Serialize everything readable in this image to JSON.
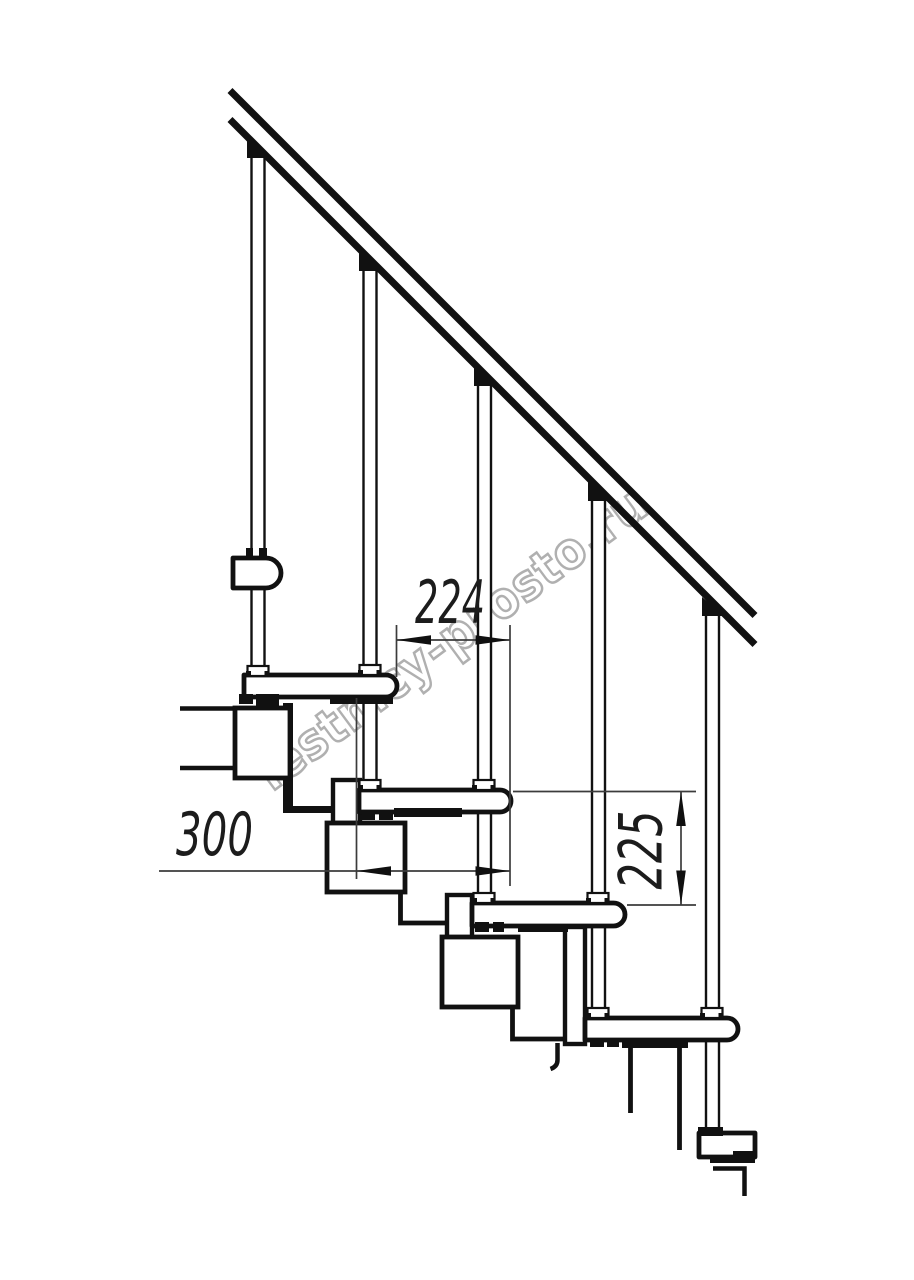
{
  "page": {
    "background": "#ffffff",
    "ink": "#111111",
    "thin_line": "#3c3c3c"
  },
  "watermark": {
    "text": "lestnicy-prosto.ru",
    "color": "#b0b0b0"
  },
  "dimensions": {
    "run": {
      "label": "224",
      "orientation": "horizontal"
    },
    "depth": {
      "label": "300",
      "orientation": "horizontal"
    },
    "rise": {
      "label": "225",
      "orientation": "vertical"
    }
  },
  "structure": {
    "type": "modular-staircase-side-view",
    "treads_visible": 6,
    "balusters_visible": 5,
    "handrail": true,
    "support_modules_visible": 3
  }
}
